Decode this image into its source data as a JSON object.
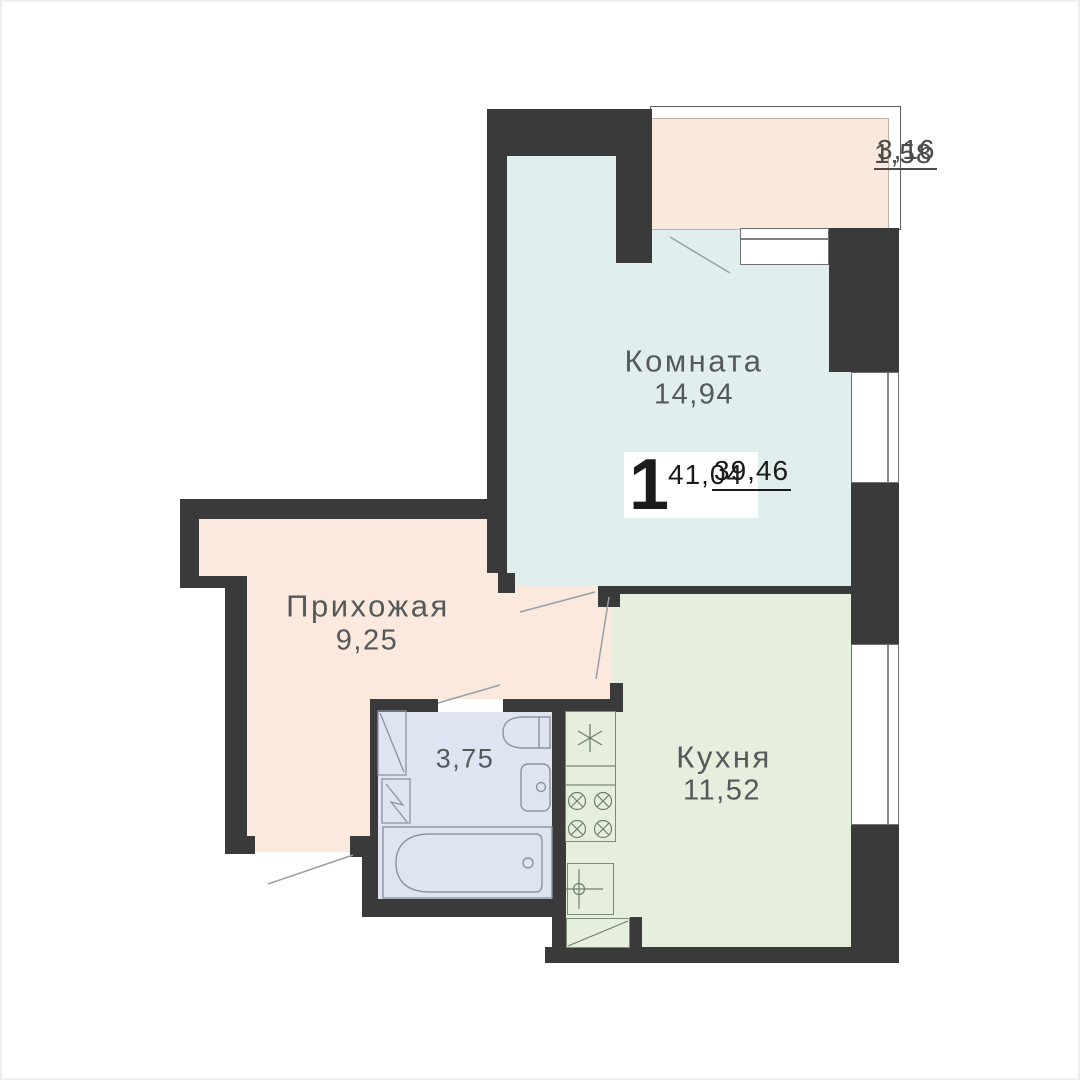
{
  "plan_title": "1-room apartment floor plan",
  "rooms": {
    "room": {
      "name": "Комната",
      "area": "14,94"
    },
    "hallway": {
      "name": "Прихожая",
      "area": "9,25"
    },
    "kitchen": {
      "name": "Кухня",
      "area": "11,52"
    },
    "bathroom": {
      "area": "3,75"
    },
    "balcony": {
      "area_full": "3,16",
      "area_reduced": "1,58"
    }
  },
  "unit": {
    "rooms_count": "1",
    "living_area": "39,46",
    "total_area": "41,04"
  },
  "colors": {
    "wall": "#3a3a3a",
    "room_fill": "#e0eeee",
    "hallway_fill": "#fbe9dd",
    "kitchen_fill": "#e6eedd",
    "bathroom_fill": "#dfe4f3",
    "balcony_fill": "#fae8dc",
    "background": "#ffffff",
    "label_text": "#55595b",
    "unit_text": "#1b1b1b"
  },
  "icons": {
    "fridge": "snowflake-icon",
    "stove_burner": "circle-cross-burner-icon",
    "kitchen_sink": "circle-cross-tap-icon",
    "bathtub": "bathtub-icon",
    "toilet": "toilet-icon",
    "bath_sink": "sink-icon",
    "shaft": "diagonal-shaft-icon",
    "door": "door-swing-line-icon",
    "window": "window-glass-line-icon"
  }
}
